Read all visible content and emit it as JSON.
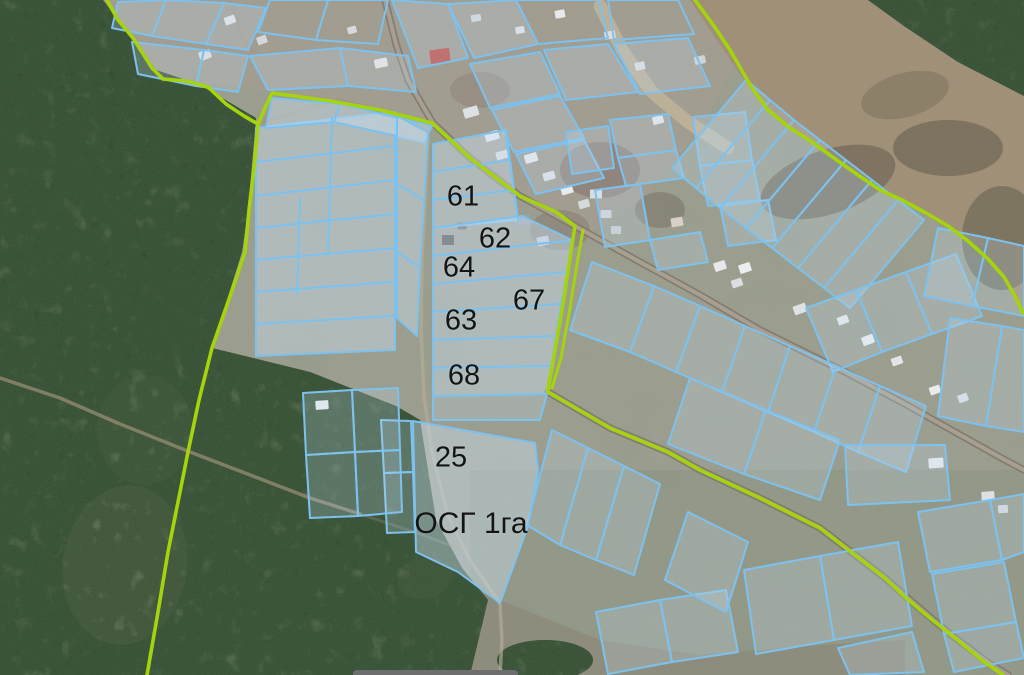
{
  "map": {
    "colors": {
      "parcel_stroke": "#7dc2ee",
      "parcel_fill_light": "rgba(198,223,244,0.24)",
      "parcel_fill_milky": "rgba(205,227,246,0.42)",
      "boundary_green": "#a6d40c",
      "road_casing": "#7f786c",
      "road_fill": "#aaa192",
      "forest": "#31462e",
      "field": "#8e9786",
      "dry_field": "#9d8c72"
    },
    "labels": [
      {
        "text": "61",
        "x": 463,
        "y": 197,
        "size": 29
      },
      {
        "text": "62",
        "x": 495,
        "y": 239,
        "size": 29
      },
      {
        "text": "64",
        "x": 459,
        "y": 268,
        "size": 29
      },
      {
        "text": "67",
        "x": 529,
        "y": 301,
        "size": 29
      },
      {
        "text": "63",
        "x": 461,
        "y": 321,
        "size": 29
      },
      {
        "text": "68",
        "x": 464,
        "y": 376,
        "size": 29
      },
      {
        "text": "25",
        "x": 451,
        "y": 458,
        "size": 29
      },
      {
        "text": "ОСГ 1га",
        "x": 471,
        "y": 524,
        "size": 30
      }
    ],
    "boundaries": [
      {
        "pts": "107,0 118,20 133,38 152,68 163,79 186,81 208,87 226,104 244,116 258,124 254,168 249,210 245,252 228,302 212,348 199,400 188,452 178,502 168,552 158,612 147,675",
        "w": 3.6
      },
      {
        "pts": "258,124 266,106 272,93 330,101 380,110 432,123 470,158 520,196 556,212 575,226 570,258 563,304 554,356 548,390",
        "w": 3.6
      },
      {
        "pts": "583,230 577,264 570,308 561,358 552,388",
        "w": 3
      },
      {
        "pts": "548,392 610,428 668,452 700,470 760,498 820,528 885,578 905,597 925,614 955,638 983,661 1003,675",
        "w": 3.6
      },
      {
        "pts": "695,0 714,26 730,50 752,88 768,110 790,128 812,142 838,161 858,175 880,190 902,200 926,213 948,226 968,241 988,259 1004,277 1016,298 1023,313",
        "w": 3.6
      }
    ],
    "roads": [
      {
        "pts": "600,6 622,50 652,92 688,122 728,148",
        "c": "#c6b89b",
        "w": 13,
        "o": 0.7
      },
      {
        "pts": "385,0 396,44 408,80 424,108 433,123 470,158 520,196 575,226 640,262 700,295 760,330 845,372 905,404 955,432 1005,460 1024,470",
        "c": "#7f786c",
        "w": 7.5,
        "o": 0.85
      },
      {
        "pts": "385,0 396,44 408,80 424,108 433,123 470,158 520,196 575,226 640,262 700,295 760,330 845,372 905,404 955,432 1005,460 1024,470",
        "c": "#aaa192",
        "w": 4,
        "o": 0.95
      },
      {
        "pts": "548,392 610,428 668,452 700,470 760,498 820,528 885,578 910,600 950,634 990,664 1008,675",
        "c": "#7f786c",
        "w": 7.5,
        "o": 0.85
      },
      {
        "pts": "548,392 610,428 668,452 700,470 760,498 820,528 885,578 910,600 950,634 990,664 1008,675",
        "c": "#aaa192",
        "w": 4,
        "o": 0.95
      },
      {
        "pts": "0,378 60,398 120,424 190,452 245,473 310,498 360,514",
        "c": "#9d9179",
        "w": 3.5,
        "o": 0.7
      },
      {
        "pts": "360,514 420,534 468,552",
        "c": "#9d9179",
        "w": 3,
        "o": 0.3
      },
      {
        "pts": "428,136 425,200 422,260 421,330 424,396 432,452 448,516 470,560 492,592 500,604 502,640 500,675",
        "c": "#b6ad97",
        "w": 3.5,
        "o": 0.65
      },
      {
        "pts": "230,0 242,36 260,62",
        "c": "#a29786",
        "w": 3,
        "o": 0.5
      },
      {
        "pts": "262,122 340,100 432,123",
        "c": "#9f9484",
        "w": 3.5,
        "o": 0.55
      }
    ],
    "parcels": [
      {
        "pts": "118,2 166,0 152,36 112,28",
        "f": 1
      },
      {
        "pts": "166,0 224,3 206,44 152,36",
        "f": 1
      },
      {
        "pts": "224,3 266,8 248,50 206,44",
        "f": 1
      },
      {
        "pts": "132,42 204,50 196,86 138,74",
        "f": 1
      },
      {
        "pts": "204,50 248,56 238,92 196,86",
        "f": 1
      },
      {
        "pts": "270,0 328,0 316,40 258,32",
        "f": 0
      },
      {
        "pts": "328,0 388,0 378,44 316,40",
        "f": 0
      },
      {
        "pts": "250,56 340,48 348,86 268,90",
        "f": 1
      },
      {
        "pts": "340,48 408,56 416,92 348,86",
        "f": 1
      },
      {
        "pts": "392,0 448,4 468,58 418,68",
        "f": 1
      },
      {
        "pts": "448,4 516,0 538,44 474,58",
        "f": 1
      },
      {
        "pts": "516,0 598,0 608,38 538,44",
        "f": 0
      },
      {
        "pts": "544,50 608,44 638,92 566,100",
        "f": 1
      },
      {
        "pts": "608,0 678,0 694,34 614,40",
        "f": 0
      },
      {
        "pts": "614,44 688,38 710,86 640,94",
        "f": 1
      },
      {
        "pts": "470,64 540,52 560,94 490,108",
        "f": 1
      },
      {
        "pts": "492,110 560,96 584,138 514,152",
        "f": 1
      },
      {
        "pts": "516,154 584,140 604,178 536,194",
        "f": 1
      },
      {
        "pts": "566,132 608,126 614,168 572,174",
        "f": 1
      },
      {
        "pts": "610,120 668,114 676,150 618,158",
        "f": 1
      },
      {
        "pts": "618,158 676,150 684,178 626,186",
        "f": 1
      },
      {
        "pts": "693,117 745,112 752,160 700,166",
        "f": 1
      },
      {
        "pts": "700,166 752,160 760,200 708,206",
        "f": 1
      },
      {
        "pts": "720,206 768,200 776,240 728,246",
        "f": 1
      },
      {
        "pts": "595,190 640,184 650,240 605,247",
        "f": 1
      },
      {
        "pts": "650,240 700,232 708,262 658,270",
        "f": 1
      },
      {
        "pts": "746,80 770,100 696,188 672,168",
        "f": 1
      },
      {
        "pts": "770,100 794,120 720,208 696,188",
        "f": 1
      },
      {
        "pts": "794,120 820,140 746,228 720,208",
        "f": 1
      },
      {
        "pts": "820,140 846,160 772,248 746,228",
        "f": 1
      },
      {
        "pts": "846,160 872,180 798,268 772,248",
        "f": 1
      },
      {
        "pts": "872,180 898,200 824,288 798,268",
        "f": 1
      },
      {
        "pts": "898,200 924,220 850,308 824,288",
        "f": 1
      },
      {
        "pts": "806,308 856,290 882,352 833,372",
        "f": 1
      },
      {
        "pts": "856,290 906,272 932,334 882,352",
        "f": 1
      },
      {
        "pts": "906,272 956,254 982,316 932,334",
        "f": 1
      },
      {
        "pts": "592,262 654,286 630,352 570,330",
        "f": 1
      },
      {
        "pts": "654,286 700,306 676,372 630,352",
        "f": 1
      },
      {
        "pts": "700,306 745,326 722,392 676,372",
        "f": 1
      },
      {
        "pts": "745,326 790,346 768,412 722,392",
        "f": 1
      },
      {
        "pts": "790,346 836,366 814,432 768,412",
        "f": 1
      },
      {
        "pts": "836,366 880,386 858,452 814,432",
        "f": 1
      },
      {
        "pts": "880,386 926,406 906,472 858,452",
        "f": 1
      },
      {
        "pts": "690,378 766,410 744,474 668,444",
        "f": 1
      },
      {
        "pts": "766,410 840,440 820,500 744,474",
        "f": 1
      },
      {
        "pts": "845,445 945,445 950,500 848,505",
        "f": 1
      },
      {
        "pts": "938,228 988,238 972,306 924,296",
        "f": 1
      },
      {
        "pts": "988,238 1024,246 1024,316 972,306",
        "f": 1
      },
      {
        "pts": "950,318 1002,326 986,426 938,416",
        "f": 1
      },
      {
        "pts": "1002,326 1024,330 1024,432 986,426",
        "f": 1
      },
      {
        "pts": "918,512 990,500 1002,560 930,572",
        "f": 1
      },
      {
        "pts": "990,500 1024,494 1024,552 1002,560",
        "f": 1
      },
      {
        "pts": "932,574 1004,562 1016,622 944,634",
        "f": 1
      },
      {
        "pts": "944,634 1016,622 1024,658 954,672",
        "f": 1
      },
      {
        "pts": "552,430 588,448 560,545 527,525",
        "f": 1
      },
      {
        "pts": "588,448 624,466 596,560 560,545",
        "f": 1
      },
      {
        "pts": "624,466 660,484 634,575 596,560",
        "f": 1
      },
      {
        "pts": "596,612 660,600 672,662 608,674",
        "f": 1
      },
      {
        "pts": "660,600 726,590 738,652 672,662",
        "f": 1
      },
      {
        "pts": "744,570 820,556 834,640 756,654",
        "f": 1
      },
      {
        "pts": "820,556 898,542 912,626 834,640",
        "f": 1
      },
      {
        "pts": "838,648 912,632 924,672 850,675",
        "f": 1
      },
      {
        "pts": "688,512 748,542 726,612 665,580",
        "f": 1
      },
      {
        "pts": "256,128 395,112 395,146 256,162",
        "f": 2
      },
      {
        "pts": "256,162 395,146 395,180 256,196",
        "f": 2
      },
      {
        "pts": "256,196 395,180 395,214 256,228",
        "f": 2
      },
      {
        "pts": "256,228 395,214 395,248 256,260",
        "f": 2
      },
      {
        "pts": "256,260 395,248 395,282 256,292",
        "f": 2
      },
      {
        "pts": "256,292 395,282 395,316 256,324",
        "f": 2
      },
      {
        "pts": "256,324 395,316 395,350 256,356",
        "f": 2
      },
      {
        "pts": "272,98 340,104 334,122 266,128",
        "f": 2
      },
      {
        "pts": "340,104 432,126 424,142 334,122",
        "f": 2
      },
      {
        "pts": "397,116 428,132 424,200 397,184",
        "f": 2
      },
      {
        "pts": "397,184 424,200 420,268 397,252",
        "f": 2
      },
      {
        "pts": "397,252 420,268 417,336 397,318",
        "f": 2
      },
      {
        "pts": "433,144 506,130 510,160 433,172",
        "f": 2
      },
      {
        "pts": "433,172 510,160 514,190 433,200",
        "f": 2
      },
      {
        "pts": "433,200 514,190 518,220 433,228",
        "f": 2
      },
      {
        "pts": "433,228 522,216 572,240 433,256",
        "f": 2
      },
      {
        "pts": "433,256 572,240 567,272 433,284",
        "f": 2
      },
      {
        "pts": "433,284 567,272 561,304 433,312",
        "f": 2
      },
      {
        "pts": "433,312 561,304 556,336 433,340",
        "f": 2
      },
      {
        "pts": "433,340 556,336 551,366 433,368",
        "f": 2
      },
      {
        "pts": "433,368 551,366 547,394 433,396",
        "f": 2
      },
      {
        "pts": "433,396 547,394 540,420 433,420",
        "f": 1
      },
      {
        "pts": "413,421 535,443 538,472 528,526 500,603 458,572 416,552",
        "f": 2
      },
      {
        "pts": "381,420 411,421 413,472 384,473",
        "f": 1
      },
      {
        "pts": "384,473 413,472 415,532 387,533",
        "f": 1
      },
      {
        "pts": "303,393 352,390 355,452 306,455",
        "f": 1
      },
      {
        "pts": "352,390 398,388 400,450 355,452",
        "f": 1
      },
      {
        "pts": "306,455 355,452 358,516 310,518",
        "f": 1
      },
      {
        "pts": "355,452 400,450 402,512 358,516",
        "f": 1
      }
    ],
    "parcel_lines": [
      "332,118 328,252",
      "300,198 297,294",
      "505,130 518,220"
    ],
    "buildings": [
      [
        440,
        56,
        20,
        14,
        -8,
        "#c05048"
      ],
      [
        381,
        63,
        13,
        9,
        -12,
        "#e6e6e2"
      ],
      [
        205,
        55,
        12,
        9,
        -20,
        "#dcdfe2"
      ],
      [
        230,
        20,
        11,
        8,
        -20,
        "#e2e5e7"
      ],
      [
        262,
        40,
        10,
        8,
        -20,
        "#d5d8da"
      ],
      [
        352,
        30,
        9,
        7,
        -15,
        "#d8dbde"
      ],
      [
        471,
        112,
        15,
        10,
        -16,
        "#dde2e4"
      ],
      [
        492,
        136,
        14,
        9,
        -16,
        "#e4e7e9"
      ],
      [
        502,
        155,
        12,
        8,
        -16,
        "#d8dde0"
      ],
      [
        531,
        158,
        13,
        9,
        -16,
        "#e6e9ec"
      ],
      [
        549,
        176,
        12,
        8,
        -16,
        "#dfe3e6"
      ],
      [
        567,
        190,
        12,
        8,
        -16,
        "#e8ebee"
      ],
      [
        584,
        204,
        11,
        8,
        -16,
        "#d4d9dc"
      ],
      [
        523,
        220,
        14,
        10,
        -12,
        "#98a2aa"
      ],
      [
        543,
        241,
        12,
        9,
        -12,
        "#c6cbd0"
      ],
      [
        448,
        240,
        12,
        10,
        0,
        "#55504a"
      ],
      [
        462,
        226,
        9,
        7,
        0,
        "#6b6660"
      ],
      [
        322,
        405,
        13,
        9,
        -4,
        "#e9eced"
      ],
      [
        596,
        194,
        12,
        9,
        0,
        "#d9dee0"
      ],
      [
        606,
        214,
        11,
        8,
        0,
        "#cfd4d8"
      ],
      [
        616,
        230,
        10,
        8,
        0,
        "#c8cdd1"
      ],
      [
        677,
        222,
        12,
        9,
        -10,
        "#d8cfc8"
      ],
      [
        720,
        266,
        12,
        9,
        -18,
        "#e6e8ea"
      ],
      [
        745,
        268,
        12,
        9,
        -18,
        "#eceeef"
      ],
      [
        737,
        283,
        11,
        8,
        -18,
        "#dadee1"
      ],
      [
        800,
        309,
        13,
        9,
        -20,
        "#dfe2e5"
      ],
      [
        843,
        320,
        11,
        8,
        -20,
        "#e6e9eb"
      ],
      [
        868,
        340,
        12,
        9,
        -20,
        "#eceeef"
      ],
      [
        897,
        361,
        11,
        8,
        -20,
        "#e2e5e8"
      ],
      [
        935,
        390,
        11,
        8,
        -20,
        "#e9ebec"
      ],
      [
        963,
        398,
        10,
        8,
        -20,
        "#dde0e3"
      ],
      [
        936,
        463,
        15,
        10,
        -4,
        "#e8eaeb"
      ],
      [
        988,
        496,
        13,
        9,
        -4,
        "#dde0e3"
      ],
      [
        1003,
        509,
        10,
        8,
        -4,
        "#d2d7da"
      ],
      [
        658,
        120,
        11,
        8,
        -14,
        "#e5e8ea"
      ],
      [
        640,
        66,
        10,
        8,
        -12,
        "#dcdfe2"
      ],
      [
        610,
        35,
        11,
        8,
        -10,
        "#dadee0"
      ],
      [
        560,
        14,
        10,
        8,
        -10,
        "#e6e8ea"
      ],
      [
        476,
        18,
        10,
        7,
        -10,
        "#d2d6d9"
      ],
      [
        520,
        30,
        9,
        7,
        -10,
        "#dfe2e4"
      ],
      [
        700,
        60,
        11,
        8,
        -12,
        "#d0d4d7"
      ]
    ]
  }
}
